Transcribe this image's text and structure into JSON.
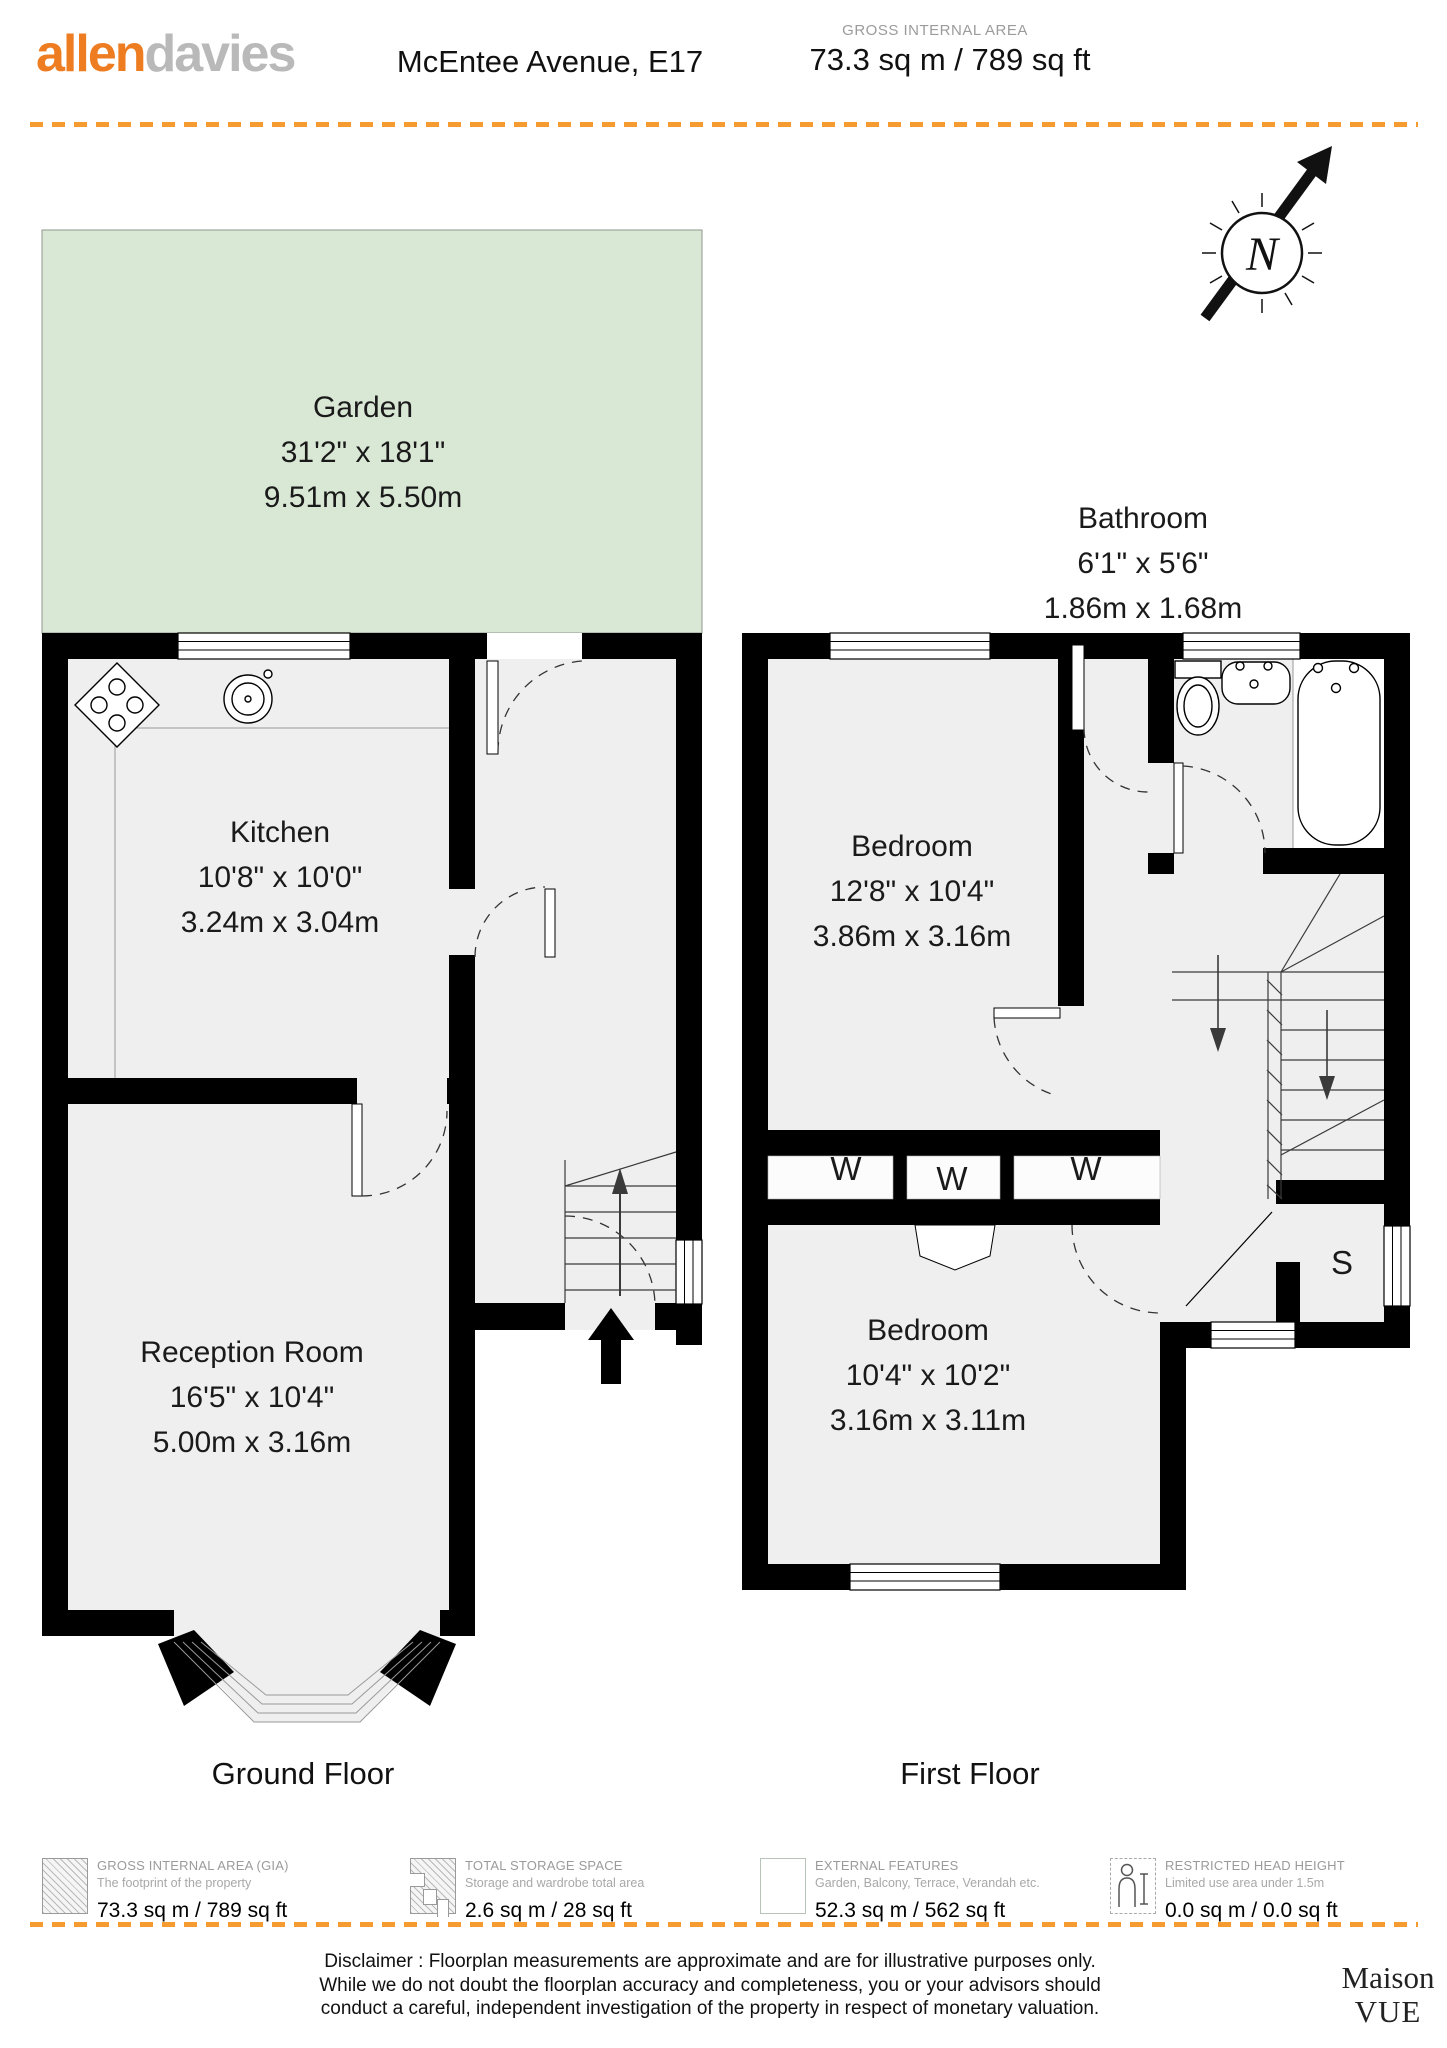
{
  "header": {
    "logo_part1": "allen",
    "logo_part2": "davies",
    "title": "McEntee Avenue, E17",
    "gia_label": "GROSS INTERNAL AREA",
    "gia_value": "73.3 sq m / 789 sq ft"
  },
  "compass": {
    "north_label": "N"
  },
  "ground_floor": {
    "caption": "Ground Floor",
    "garden": {
      "name": "Garden",
      "imperial": "31'2\" x 18'1\"",
      "metric": "9.51m x 5.50m"
    },
    "kitchen": {
      "name": "Kitchen",
      "imperial": "10'8\" x 10'0\"",
      "metric": "3.24m x 3.04m"
    },
    "reception": {
      "name": "Reception Room",
      "imperial": "16'5\" x 10'4\"",
      "metric": "5.00m x 3.16m"
    }
  },
  "first_floor": {
    "caption": "First Floor",
    "bathroom": {
      "name": "Bathroom",
      "imperial": "6'1\" x 5'6\"",
      "metric": "1.86m x 1.68m"
    },
    "bedroom1": {
      "name": "Bedroom",
      "imperial": "12'8\" x 10'4\"",
      "metric": "3.86m x 3.16m"
    },
    "bedroom2": {
      "name": "Bedroom",
      "imperial": "10'4\" x 10'2\"",
      "metric": "3.16m x 3.11m"
    },
    "wardrobe_label": "W",
    "storage_label": "S"
  },
  "legend": {
    "items": [
      {
        "icon": "hatch-diagonal-icon",
        "title": "GROSS INTERNAL AREA (GIA)",
        "subtitle": "The footprint of the property",
        "value": "73.3 sq m / 789 sq ft"
      },
      {
        "icon": "hatch-storage-icon",
        "title": "TOTAL STORAGE SPACE",
        "subtitle": "Storage and wardrobe total area",
        "value": "2.6 sq m / 28 sq ft"
      },
      {
        "icon": "grid-icon",
        "title": "EXTERNAL FEATURES",
        "subtitle": "Garden, Balcony, Terrace, Verandah etc.",
        "value": "52.3 sq m / 562 sq ft"
      },
      {
        "icon": "person-height-icon",
        "title": "RESTRICTED HEAD HEIGHT",
        "subtitle": "Limited use area under 1.5m",
        "value": "0.0 sq m / 0.0 sq ft"
      }
    ]
  },
  "disclaimer": {
    "line1": "Disclaimer : Floorplan measurements are approximate and are for illustrative purposes only.",
    "line2": "While we do not doubt the floorplan accuracy and completeness, you or your advisors should",
    "line3": "conduct a careful, independent investigation of the property in respect of monetary valuation."
  },
  "brand": {
    "name_line1": "Maison",
    "name_line2": "VUE"
  },
  "colors": {
    "accent_orange": "#F59B30",
    "logo_orange": "#EE7D22",
    "logo_gray": "#B9B9B9",
    "garden_green": "#D9E8D5",
    "floor_gray": "#EFEFEF",
    "wall_black": "#000000"
  }
}
